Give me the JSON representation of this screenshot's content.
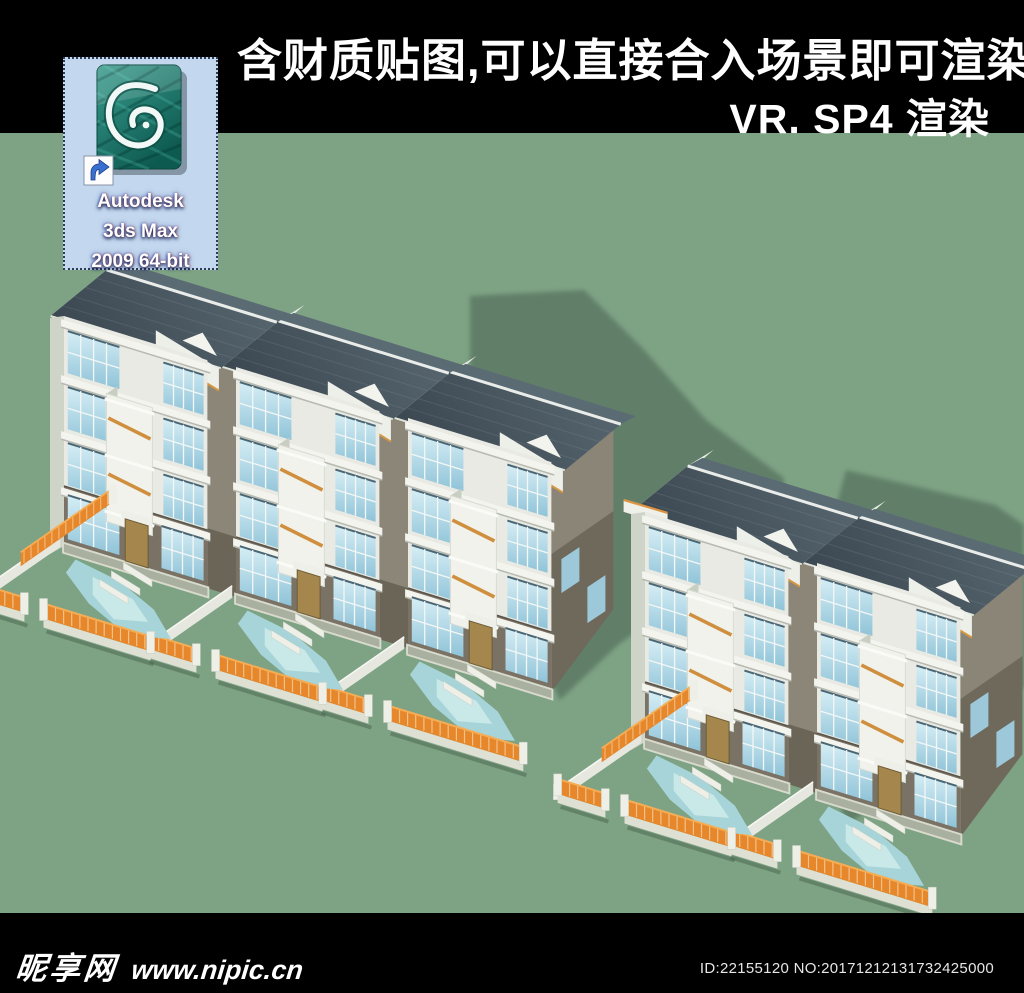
{
  "top_banner": {
    "line1": "含财质贴图,可以直接合入场景即可渲染",
    "line2": "VR. SP4 渲染",
    "bg": "#000000",
    "text_color": "#ffffff"
  },
  "desktop_icon": {
    "label_lines": [
      "Autodesk",
      "3ds Max",
      "2009 64-bit"
    ],
    "selected": true,
    "selection_bg": "#c3d7ee",
    "icon_teal": "#17806f"
  },
  "bottom_banner": {
    "site_name": "昵享网",
    "site_url": "www.nipic.cn",
    "id_text": "ID:22155120 NO:20171212131732425000",
    "bg": "#000000"
  },
  "scene": {
    "buildings": [
      {
        "units": 3,
        "position": "left"
      },
      {
        "units": 2,
        "position": "right"
      }
    ],
    "palette": {
      "background_green": "#7ea284",
      "shadow_green": "#5f7d66",
      "bar_black": "#000000",
      "roof_dark": "#3a4650",
      "roof_light": "#57666f",
      "wall_white": "#e9eae3",
      "wall_grey": "#7a7264",
      "wall_grey_dark": "#6e695b",
      "glass_top": "#d6eef5",
      "glass_bottom": "#8fc3d8",
      "fence_orange": "#e6872b",
      "rail_orange": "#d08f3e",
      "path_cyan": "#a6d4d8",
      "door_tan": "#a5874e",
      "selection_blue": "#c3d7ee"
    }
  }
}
